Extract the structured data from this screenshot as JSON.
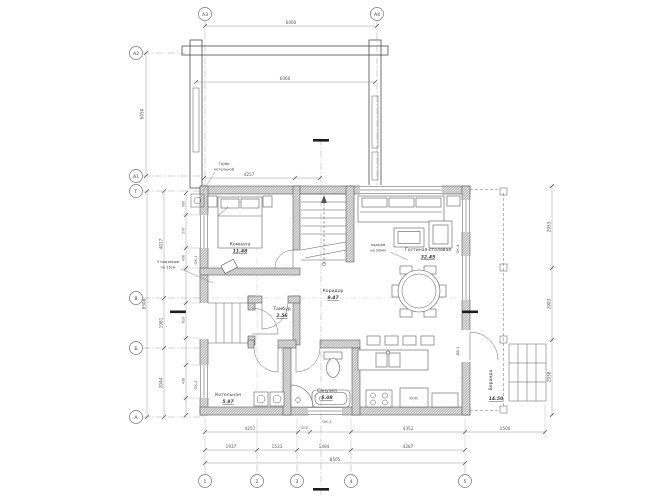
{
  "axes": {
    "a2": "А2",
    "a1": "А1",
    "g": "Г",
    "v": "В",
    "b": "Б",
    "a": "А",
    "a3": "А3",
    "a4": "А4",
    "n1": "1",
    "n2": "2",
    "n3": "3",
    "n4": "4",
    "n5": "5"
  },
  "rooms": {
    "bedroom": {
      "name": "Комната",
      "area": "11.48"
    },
    "living": {
      "name": "Гостиная-столовая",
      "area": "32.45"
    },
    "corridor": {
      "name": "Коридор",
      "area": "9.47"
    },
    "tambour": {
      "name": "Тамбур",
      "area": "2.56"
    },
    "boiler": {
      "name": "Котельная",
      "area": "5.97"
    },
    "bath": {
      "name": "Санузел",
      "area": "5.08"
    },
    "veranda": {
      "name": "Веранда",
      "area": "14.50"
    }
  },
  "labels": {
    "fridge": "ХОЛ."
  },
  "marks": {
    "ok1": "ОК-1",
    "ok2": "ОК-2",
    "ok3": "ОК-3",
    "ok4": "ОК-4",
    "dv1": "ДВ-1"
  },
  "notes": {
    "chimney": [
      "Труба",
      "котельной"
    ],
    "steps": [
      "5 подъёмов",
      "по 15см"
    ],
    "level": [
      "подъём",
      "на 20мм"
    ]
  },
  "dims": {
    "carport_top": "6060",
    "carport_inner": "6060",
    "carport_left": "6050",
    "house_top": "4257",
    "b1": [
      "4257",
      "1010",
      "4352",
      "1500"
    ],
    "b2": [
      "1937",
      "1533",
      "1494",
      "4287"
    ],
    "b3": [
      "8505"
    ],
    "l_in": [
      "900",
      "570",
      "436",
      "610",
      "436"
    ],
    "l_mid": [
      "4017",
      "1981",
      "2044"
    ],
    "l_total": "8508",
    "r_out": [
      "2933",
      "2903",
      "2938"
    ]
  },
  "colors": {
    "line": "#4c4c4c",
    "dim": "#8c8c8c",
    "wall_fill": "#dcdcdc",
    "bg": "#ffffff"
  }
}
